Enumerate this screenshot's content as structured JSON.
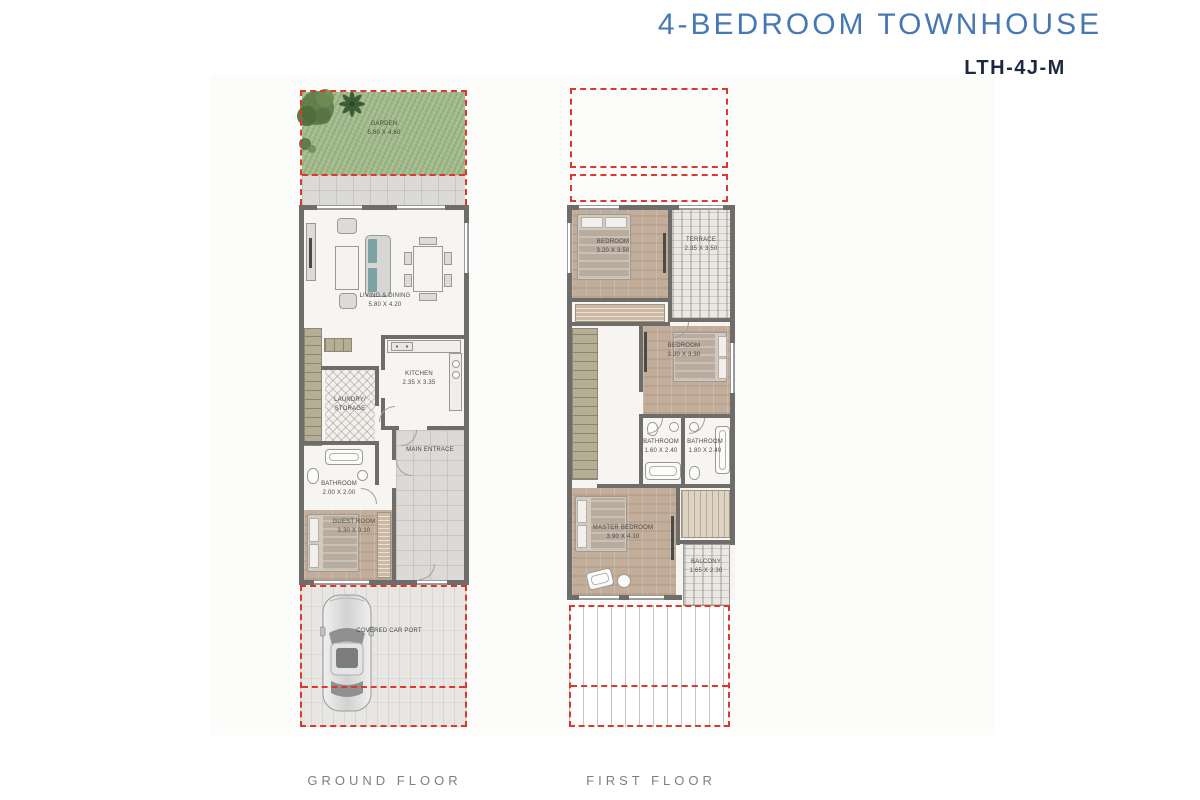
{
  "title": "4-BEDROOM TOWNHOUSE",
  "unit_code": "LTH-4J-M",
  "colors": {
    "accent_blue": "#4679b4",
    "code_navy": "#1b2840",
    "dash_red": "#dc382d",
    "wall_gray": "#6e6d6a",
    "garden_green": "#a4bc8e",
    "floor_label_gray": "#7f7f7f"
  },
  "ground_floor": {
    "label": "GROUND FLOOR",
    "rooms": {
      "garden": {
        "name": "GARDEN",
        "dims": "5.80 X 4.60"
      },
      "living_dining": {
        "name": "LIVING & DINING",
        "dims": "5.80 X 4.20"
      },
      "kitchen": {
        "name": "KITCHEN",
        "dims": "2.35 X 3.35"
      },
      "laundry_storage": {
        "name": "LAUNDRY/ STORAGE"
      },
      "bathroom": {
        "name": "BATHROOM",
        "dims": "2.00 X 2.00"
      },
      "main_entrance": {
        "name": "MAIN ENTRACE"
      },
      "guest_room": {
        "name": "GUEST ROOM",
        "dims": "3.30 X 3.10"
      },
      "car_port": {
        "name": "COVERED CAR PORT"
      }
    }
  },
  "first_floor": {
    "label": "FIRST FLOOR",
    "rooms": {
      "bedroom_1": {
        "name": "BEDROOM",
        "dims": "3.20 X 3.50"
      },
      "terrace": {
        "name": "TERRACE",
        "dims": "2.35 X 3.50"
      },
      "bedroom_2": {
        "name": "BEDROOM",
        "dims": "3.30 X 3.30"
      },
      "bathroom_1": {
        "name": "BATHROOM",
        "dims": "1.60 X 2.40"
      },
      "bathroom_2": {
        "name": "BATHROOM",
        "dims": "1.80 X 2.40"
      },
      "master_bedroom": {
        "name": "MASTER BEDROOM",
        "dims": "3.90 X 4.10"
      },
      "balcony": {
        "name": "BALCONY",
        "dims": "1.65 X 2.30"
      }
    }
  }
}
